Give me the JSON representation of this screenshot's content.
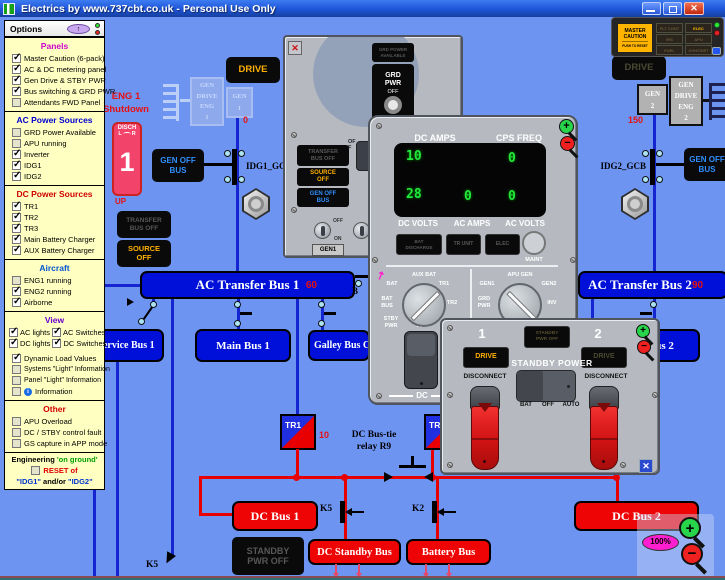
{
  "titlebar": {
    "title": "Electrics by www.737cbt.co.uk - Personal Use Only"
  },
  "icons": {
    "close": "✕",
    "up_arrow": "↑",
    "info": "i",
    "pointer_arrow": "↗",
    "zoom_in": "+",
    "zoom_out": "−"
  },
  "options": {
    "title": "Options",
    "panels": {
      "heading": "Panels",
      "items": [
        {
          "label": "Master Caution (6-pack)",
          "checked": true
        },
        {
          "label": "AC & DC metering panel",
          "checked": true
        },
        {
          "label": "Gen Drive & STBY PWR",
          "checked": true
        },
        {
          "label": "Bus switching & GRD PWR",
          "checked": true
        },
        {
          "label": "Attendants FWD Panel",
          "checked": false
        }
      ]
    },
    "ac_power": {
      "heading": "AC Power Sources",
      "items": [
        {
          "label": "GRD Power Available",
          "checked": false
        },
        {
          "label": "APU running",
          "checked": false
        },
        {
          "label": "Inverter",
          "checked": true
        },
        {
          "label": "IDG1",
          "checked": true
        },
        {
          "label": "IDG2",
          "checked": true
        }
      ]
    },
    "dc_power": {
      "heading": "DC Power Sources",
      "items": [
        {
          "label": "TR1",
          "checked": true
        },
        {
          "label": "TR2",
          "checked": true
        },
        {
          "label": "TR3",
          "checked": true
        },
        {
          "label": "Main Battery Charger",
          "checked": true
        },
        {
          "label": "AUX Battery Charger",
          "checked": true
        }
      ]
    },
    "aircraft": {
      "heading": "Aircraft",
      "items": [
        {
          "label": "ENG1 running",
          "checked": false
        },
        {
          "label": "ENG2 running",
          "checked": true
        },
        {
          "label": "Airborne",
          "checked": true
        }
      ]
    },
    "view": {
      "heading": "View",
      "row1": {
        "a": "AC lights",
        "a_on": true,
        "b": "AC Switches",
        "b_on": true
      },
      "row2": {
        "a": "DC lights",
        "a_on": true,
        "b": "DC Switches",
        "b_on": true
      },
      "items": [
        {
          "label": "Dynamic Load Values",
          "checked": true
        },
        {
          "label": "Systems \"Light\" Information",
          "checked": false
        },
        {
          "label": "Panel \"Light\" Information",
          "checked": false
        },
        {
          "label": "Information",
          "checked": false
        }
      ]
    },
    "other": {
      "heading": "Other",
      "items": [
        {
          "label": "APU Overload",
          "checked": false
        },
        {
          "label": "DC / STBY control fault",
          "checked": false
        },
        {
          "label": "GS capture in APP mode",
          "checked": false
        }
      ]
    },
    "engineering": {
      "word": "Engineering",
      "on_ground": "'on ground'",
      "reset": "RESET of",
      "reset_checked": false,
      "idg1": "\"IDG1\"",
      "andor": "and/or",
      "idg2": "\"IDG2\""
    }
  },
  "sixpack": {
    "master_caution": [
      "MASTER",
      "CAUTION"
    ],
    "push_to_reset": "PUSH TO RESET",
    "annunciators": [
      {
        "label": "FLT CONT",
        "lit": false
      },
      {
        "label": "ELEC",
        "lit": true
      },
      {
        "label": "IRS",
        "lit": false
      },
      {
        "label": "APU",
        "lit": false
      },
      {
        "label": "FUEL",
        "lit": false
      },
      {
        "label": "OVHT/DET",
        "lit": false
      }
    ]
  },
  "lights": {
    "master_caution": true,
    "drive_eng1": true,
    "drive_eng2": false,
    "transfer_bus_off_ext": false,
    "source_off_ext": true,
    "gen_off_bus_left": true,
    "gen_off_bus_right": true,
    "panel_transfer_bus_off": false,
    "panel_source_off": true,
    "panel_gen_off_bus": true,
    "grd_power_available": false,
    "stby_drive1": true,
    "stby_drive2": false,
    "standby_pwr_off": false
  },
  "schematic": {
    "eng1_status": [
      "ENG 1",
      "Shutdown"
    ],
    "fire_handle": {
      "disch": "DISCH",
      "l": "L",
      "r": "R",
      "num": "1",
      "up": "UP"
    },
    "drive_eng1": "DRIVE",
    "drive_eng2": "DRIVE",
    "gen_drive_eng1": [
      "GEN",
      "DRIVE",
      "ENG",
      "1"
    ],
    "gen1": [
      "GEN",
      "1"
    ],
    "gen_drive_eng2": [
      "GEN",
      "DRIVE",
      "ENG",
      "2"
    ],
    "gen2": [
      "GEN",
      "2"
    ],
    "gen_off_bus_left": [
      "GEN OFF",
      "BUS"
    ],
    "gen_off_bus_right": [
      "GEN OFF",
      "BUS"
    ],
    "transfer_bus_off": [
      "TRANSFER",
      "BUS OFF"
    ],
    "source_off": [
      "SOURCE",
      "OFF"
    ],
    "idg1_gcb": "IDG1_GCB",
    "idg2_gcb": "IDG2_GCB",
    "loads": {
      "idg1": "0",
      "idg2": "150",
      "ac_bus1": "60",
      "ac_bus2": "90",
      "tr1": "10"
    },
    "buses": {
      "ac1": "AC Transfer Bus 1",
      "ac2": "AC Transfer Bus 2",
      "service1": "Service Bus 1",
      "main1": "Main Bus 1",
      "galley": "Galley Bus C",
      "main2": "Main Bus 2",
      "dc1": "DC Bus 1",
      "dc2": "DC Bus 2",
      "dc_standby": "DC Standby Bus",
      "battery": "Battery Bus"
    },
    "tr1": "TR1",
    "tr2": "TR2",
    "bus_tie_label": [
      "DC Bus-tie",
      "relay R9"
    ],
    "k5": "K5",
    "k2": "K2",
    "k5_feeder": "K5",
    "b_partial": "B",
    "standby_pwr_off": [
      "STANDBY",
      "PWR OFF"
    ]
  },
  "metering": {
    "dc_amps_label": "DC AMPS",
    "cps_freq_label": "CPS FREQ",
    "values": {
      "dc_amps": "10",
      "cps_freq": "0",
      "dc_volts": "28",
      "ac_amps": "0",
      "ac_volts": "0"
    },
    "dc_volts_label": "DC VOLTS",
    "ac_amps_label": "AC AMPS",
    "ac_volts_label": "AC VOLTS",
    "buttons": {
      "bat_discharge": [
        "BAT",
        "DISCHARGE"
      ],
      "tr_unit": "TR UNIT",
      "elec": "ELEC",
      "maint": "MAINT"
    },
    "dc_sel": {
      "bat": "BAT",
      "aux_bat": "AUX BAT",
      "tr1": "TR1",
      "tr2": "TR2",
      "bat_bus": "BAT\nBUS",
      "stby_pwr": "STBY\nPWR",
      "test": "TEST"
    },
    "ac_sel": {
      "gen1": "GEN1",
      "apu_gen": "APU GEN",
      "gen2": "GEN2",
      "grd_pwr": "GRD\nPWR",
      "inv": "INV"
    },
    "dc_footer": "DC"
  },
  "bus_switch": {
    "grd_power_available": [
      "GRD POWER",
      "AVAILABLE"
    ],
    "grd_pwr": [
      "GRD",
      "PWR"
    ],
    "off_small": "OFF",
    "transfer_bus_off": [
      "TRANSFER",
      "BUS OFF"
    ],
    "source_off": [
      "SOURCE",
      "OFF"
    ],
    "gen_off_bus": [
      "GEN OFF",
      "BUS"
    ],
    "off_vert": "OFF",
    "off": "OFF",
    "on": "ON",
    "gen1": "GEN1"
  },
  "standby": {
    "n1": "1",
    "n2": "2",
    "standby_pwr_off": [
      "STANDBY",
      "PWR OFF"
    ],
    "drive1": "DRIVE",
    "drive2": "DRIVE",
    "title": "STANDBY POWER",
    "disconnect": "DISCONNECT",
    "bat": "BAT",
    "off": "OFF",
    "auto": "AUTO"
  },
  "zoom": {
    "percent": "100%"
  },
  "colors": {
    "background": "#6e94f2",
    "bus_blue": "#0010d8",
    "bus_red": "#ee0404",
    "line_blue": "#1525cf",
    "line_red": "#e80000",
    "amber": "#ffb000",
    "lit_blue": "#2f8fff",
    "green_digit": "#22e83c",
    "magenta": "#ff1fd0",
    "options_yellow": "#ffffc2",
    "panel_gray": "#b6bac0"
  }
}
